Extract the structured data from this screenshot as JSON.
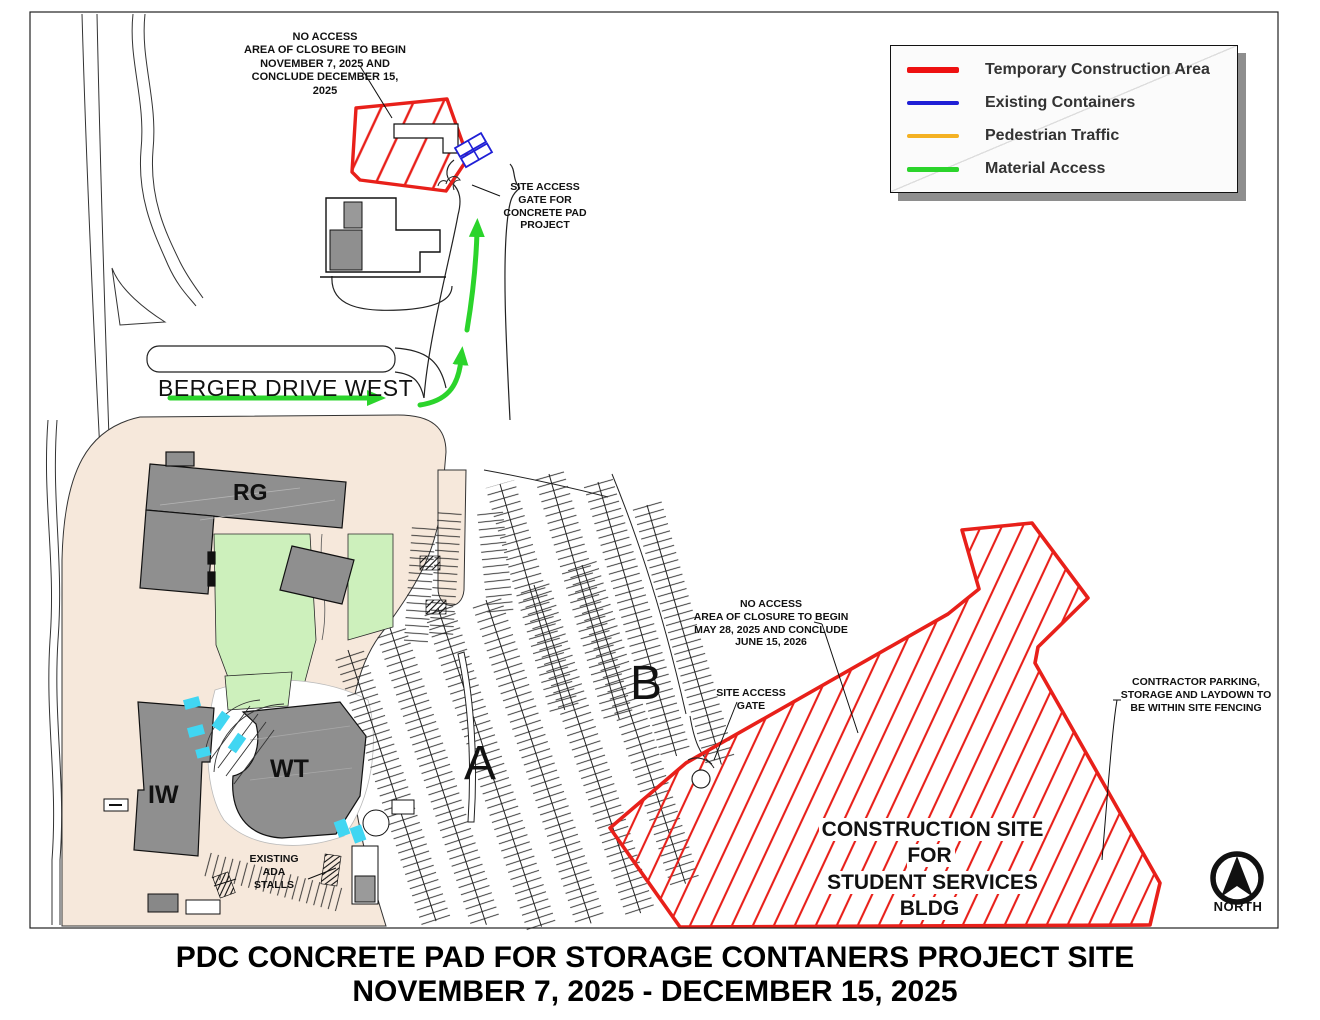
{
  "page": {
    "title_line1": "PDC CONCRETE PAD FOR STORAGE CONTANERS PROJECT SITE",
    "title_line2": "NOVEMBER 7, 2025 - DECEMBER 15, 2025"
  },
  "legend": {
    "items": [
      {
        "label": "Temporary Construction Area",
        "color": "#ee1111"
      },
      {
        "label": "Existing Containers",
        "color": "#1f1fd6"
      },
      {
        "label": "Pedestrian Traffic",
        "color": "#f4b123"
      },
      {
        "label": "Material Access",
        "color": "#2bd42b"
      }
    ]
  },
  "map": {
    "street_label": "BERGER DRIVE WEST",
    "buildings": {
      "rg": "RG",
      "wt": "WT",
      "iw": "IW"
    },
    "lots": {
      "a": "A",
      "b": "B"
    },
    "north_label": "NORTH",
    "annotations": {
      "no_access_top": "NO ACCESS\nAREA OF CLOSURE TO BEGIN\nNOVEMBER 7, 2025 AND\nCONCLUDE DECEMBER 15,\n2025",
      "gate_top": "SITE ACCESS\nGATE FOR\nCONCRETE PAD\nPROJECT",
      "no_access_main": "NO ACCESS\nAREA OF CLOSURE TO BEGIN\nMAY 28, 2025 AND CONCLUDE\nJUNE 15, 2026",
      "gate_main": "SITE ACCESS\nGATE",
      "contractor": "CONTRACTOR PARKING,\nSTORAGE AND LAYDOWN TO\nBE WITHIN SITE FENCING",
      "ada": "EXISTING\nADA\nSTALLS",
      "construction_site_line1": "CONSTRUCTION SITE FOR",
      "construction_site_line2": "STUDENT SERVICES BLDG"
    }
  },
  "colors": {
    "construction_red": "#e8201a",
    "containers_blue": "#1f1fd6",
    "pedestrian_orange": "#f4b123",
    "material_green": "#2bd42b",
    "lawn_green": "#cdf0bc",
    "plaza_tan": "#f6e8db",
    "building_gray": "#8f8f8f",
    "accent_cyan": "#41d6f2"
  }
}
